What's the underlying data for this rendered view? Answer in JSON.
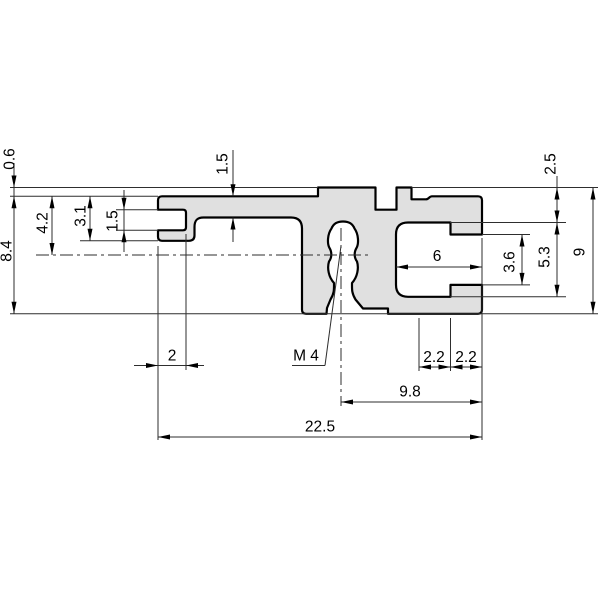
{
  "drawing": {
    "type": "technical-cross-section",
    "part_fill_color": "#e0e0e0",
    "outline_color": "#000000",
    "dim_line_color": "#2e2e2e",
    "thread_callout": "M 4",
    "dimensions": {
      "top_step": "0.6",
      "height_below_top": "8.4",
      "axis_from_top": "4.2",
      "clip_height": "3.1",
      "clip_slot_height": "1.5",
      "plate_thickness": "1.5",
      "clip_slot_depth": "2",
      "lip_from_top": "2.5",
      "slot_inner_height": "5.3",
      "total_height": "9",
      "slot_mouth_height": "3.6",
      "slot_depth": "6",
      "lip_width_a": "2.2",
      "lip_width_b": "2.2",
      "thread_to_face": "9.8",
      "total_width": "22.5"
    }
  }
}
